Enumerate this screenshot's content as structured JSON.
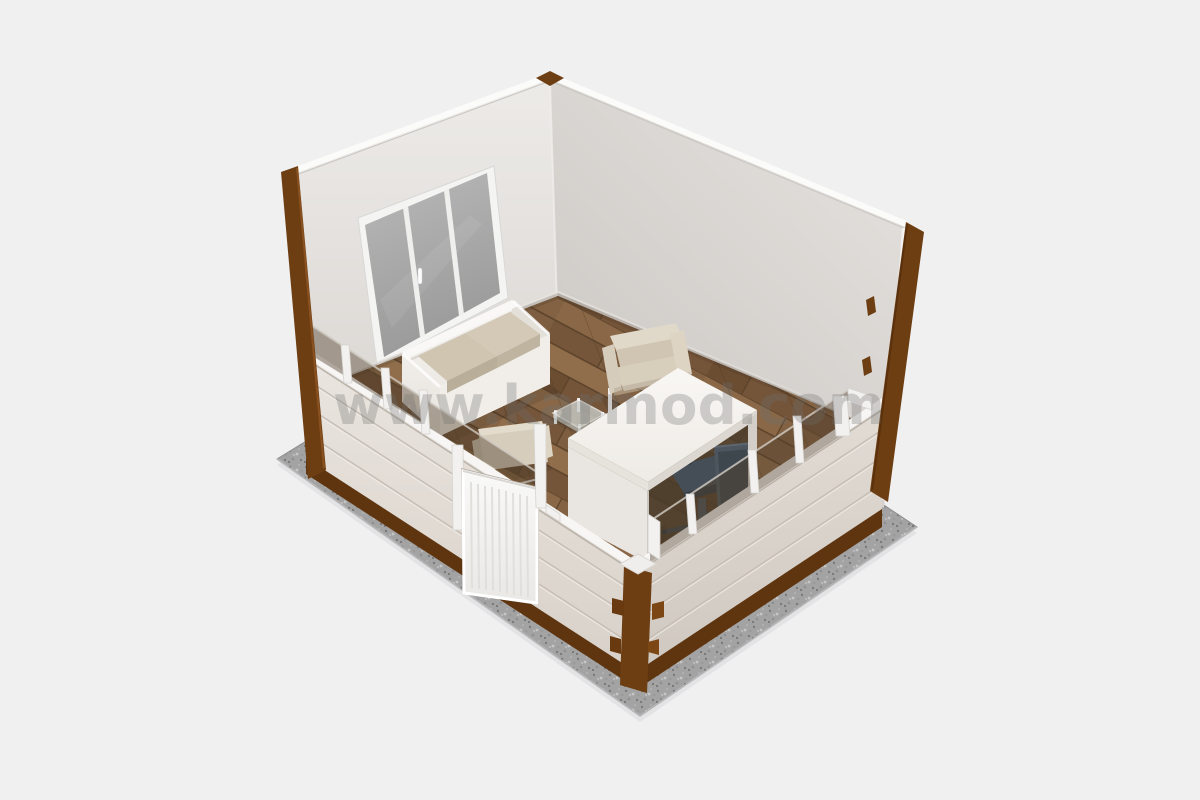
{
  "image": {
    "description": "3D isometric cutaway render of a small prefabricated office room on a gravel foundation slab",
    "style": "architectural visualization"
  },
  "watermark": {
    "text": "www.karmod.com"
  },
  "colors": {
    "background": "#f0f0f1",
    "wall-left": "#e3dfdb",
    "wall-right": "#d9d5d1",
    "panel": "#e4dfd8",
    "frame-brown": "#6e3e13",
    "skirt-brown": "#5f3510",
    "floor": "#7d5c3e",
    "gravel": "#a3a3a3",
    "window-glass": "#a9aaa9",
    "tint-glass": "#54402c",
    "sofa": "#f3f1ed",
    "cushion": "#cfc5b1",
    "desk": "#f6f4f1",
    "armchair": "#d6cdbd",
    "office-chair": "#4a535b",
    "door": "#f6f6f5",
    "watermark": "#6f6f6f"
  },
  "scene": {
    "objects": [
      "gravel-foundation-slab",
      "back-left-wall",
      "back-right-wall",
      "triple-pane-window",
      "wood-parquet-floor",
      "two-seat-sofa",
      "coffee-table",
      "guest-armchair-rear",
      "guest-armchair-front",
      "office-desk",
      "office-chair",
      "front-left-cutaway-wall",
      "entrance-door",
      "front-right-cutaway-wall",
      "corner-post-left",
      "corner-post-right",
      "corner-post-front"
    ]
  }
}
